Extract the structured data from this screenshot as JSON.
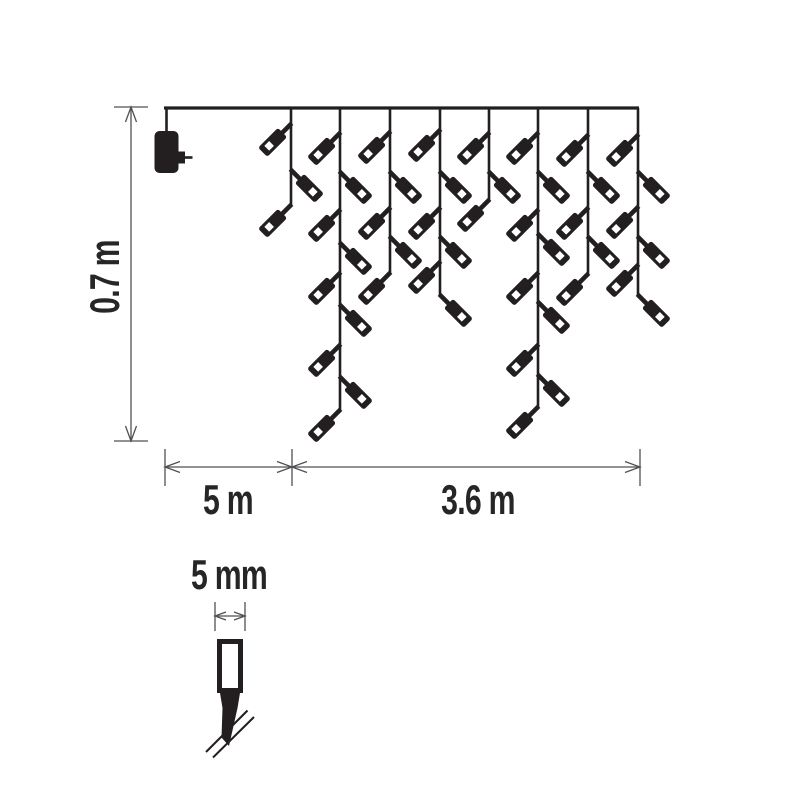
{
  "diagram": {
    "title": "icicle-light-chain-dimension-diagram",
    "background": "#ffffff",
    "ink": "#231f20",
    "dim_color": "#515155",
    "light_chain": {
      "wire": {
        "x1": 164,
        "x2": 639,
        "y": 108,
        "stroke_width": 3.2
      },
      "adapter": {
        "drop_x": 166.5,
        "drop_y1": 108,
        "drop_y2": 133,
        "body": {
          "x": 154.5,
          "y": 131,
          "w": 24,
          "h": 42,
          "r": 5
        },
        "prong": {
          "x": 177,
          "y": 151.5,
          "w": 8,
          "h": 12
        },
        "pin": {
          "x1": 185,
          "x2": 192.5,
          "y": 157.5
        }
      },
      "strand_stroke": 2.6,
      "bulb_shape": {
        "stub_len": 16,
        "stub_w": 4.6,
        "body_start": 12,
        "body_len": 28,
        "body_w": 13,
        "window": 6.8,
        "window_at": 27.5
      },
      "strands": [
        {
          "x": 291,
          "bottom": 205,
          "end_side": "L",
          "bulbs": [
            {
              "y": 124,
              "side": "L"
            },
            {
              "y": 170,
              "side": "R"
            }
          ]
        },
        {
          "x": 340,
          "bottom": 410,
          "end_side": "L",
          "bulbs": [
            {
              "y": 133,
              "side": "L"
            },
            {
              "y": 172,
              "side": "R"
            },
            {
              "y": 210,
              "side": "L"
            },
            {
              "y": 243,
              "side": "R"
            },
            {
              "y": 273,
              "side": "L"
            },
            {
              "y": 305,
              "side": "R"
            },
            {
              "y": 345,
              "side": "L"
            },
            {
              "y": 377,
              "side": "R"
            }
          ]
        },
        {
          "x": 390,
          "bottom": 273,
          "end_side": "L",
          "bulbs": [
            {
              "y": 132,
              "side": "L"
            },
            {
              "y": 172,
              "side": "R"
            },
            {
              "y": 208,
              "side": "L"
            },
            {
              "y": 237,
              "side": "R"
            }
          ]
        },
        {
          "x": 440,
          "bottom": 295,
          "end_side": "R",
          "bulbs": [
            {
              "y": 130,
              "side": "L"
            },
            {
              "y": 172,
              "side": "R"
            },
            {
              "y": 208,
              "side": "L"
            },
            {
              "y": 237,
              "side": "R"
            },
            {
              "y": 262,
              "side": "L"
            }
          ]
        },
        {
          "x": 489,
          "bottom": 200,
          "end_side": "L",
          "bulbs": [
            {
              "y": 133,
              "side": "L"
            },
            {
              "y": 172,
              "side": "R"
            }
          ]
        },
        {
          "x": 538,
          "bottom": 407,
          "end_side": "L",
          "bulbs": [
            {
              "y": 133,
              "side": "L"
            },
            {
              "y": 172,
              "side": "R"
            },
            {
              "y": 210,
              "side": "L"
            },
            {
              "y": 234,
              "side": "R"
            },
            {
              "y": 273,
              "side": "L"
            },
            {
              "y": 302,
              "side": "R"
            },
            {
              "y": 345,
              "side": "L"
            },
            {
              "y": 375,
              "side": "R"
            }
          ]
        },
        {
          "x": 588,
          "bottom": 274,
          "end_side": "L",
          "bulbs": [
            {
              "y": 135,
              "side": "L"
            },
            {
              "y": 172,
              "side": "R"
            },
            {
              "y": 208,
              "side": "L"
            },
            {
              "y": 237,
              "side": "R"
            }
          ]
        },
        {
          "x": 638,
          "bottom": 295,
          "end_side": "R",
          "bulbs": [
            {
              "y": 135,
              "side": "L"
            },
            {
              "y": 172,
              "side": "R"
            },
            {
              "y": 207,
              "side": "L"
            },
            {
              "y": 237,
              "side": "R"
            },
            {
              "y": 265,
              "side": "L"
            }
          ]
        }
      ]
    },
    "dimensions": {
      "height": {
        "label": "0.7 m",
        "value_m": 0.7,
        "x": 131,
        "y1": 107,
        "y2": 441,
        "tick_x1": 114,
        "tick_x2": 148,
        "label_cx": 104,
        "label_cy": 277
      },
      "baseline": {
        "y": 467,
        "tick_y1": 449,
        "tick_y2": 486,
        "ticks_x": [
          165,
          292,
          640
        ]
      },
      "lead": {
        "label": "5 m",
        "value_m": 5,
        "x1": 165,
        "x2": 292,
        "label_cx": 228,
        "label_y": 514
      },
      "lit": {
        "label": "3.6 m",
        "value_m": 3.6,
        "x1": 292,
        "x2": 640,
        "label_cx": 478,
        "label_y": 514
      },
      "arrow": {
        "len": 15,
        "half": 5.5
      }
    },
    "bulb_detail": {
      "label": "5 mm",
      "value_mm": 5,
      "label_cx": 229,
      "label_y": 589,
      "dim": {
        "x1": 215,
        "x2": 245,
        "y": 616,
        "tick_y1": 602,
        "tick_y2": 631,
        "arrow_len": 11,
        "arrow_half": 4
      },
      "body": {
        "x": 219.5,
        "y": 641.5,
        "w": 21,
        "h": 49,
        "stroke": 5
      },
      "socket": [
        [
          220,
          693
        ],
        [
          240,
          693
        ],
        [
          237.5,
          708
        ],
        [
          222.5,
          708
        ]
      ],
      "tail": [
        [
          222.5,
          708
        ],
        [
          237.5,
          708
        ],
        [
          229,
          746
        ],
        [
          221.5,
          737.5
        ]
      ],
      "break_lines": [
        [
          206,
          752,
          247.5,
          710.5
        ],
        [
          213,
          757.5,
          254,
          717
        ]
      ]
    }
  }
}
